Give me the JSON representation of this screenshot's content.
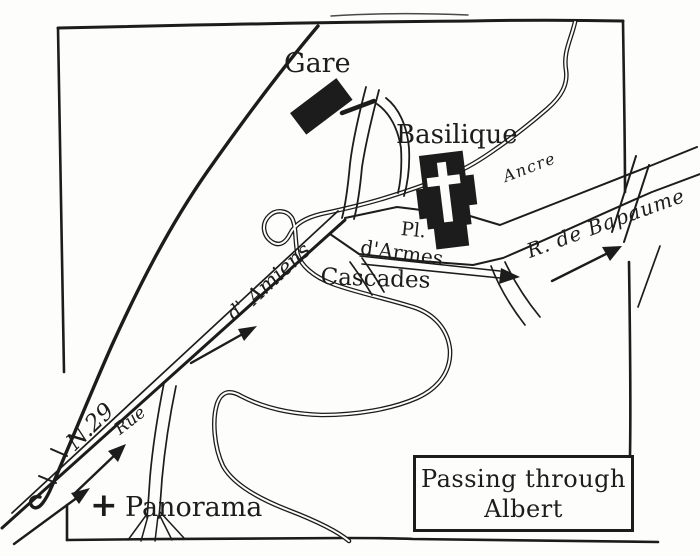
{
  "map": {
    "title": {
      "line1": "Passing through",
      "line2": "Albert"
    },
    "labels": {
      "station": "Gare",
      "basilica": "Basilique",
      "river": "Ancre",
      "square_line1": "Pl.",
      "square_line2": "d'Armes",
      "cascades": "Cascades",
      "bapaume_road": "R. de Bapaume",
      "amiens_prefix": "d'",
      "amiens_road": "Amiens",
      "rue": "Rue",
      "route_number": "N.29",
      "panorama": "Panorama",
      "panorama_marker": "+"
    },
    "colors": {
      "ink": "#1c1c1c",
      "paper": "#fdfdfb"
    }
  }
}
